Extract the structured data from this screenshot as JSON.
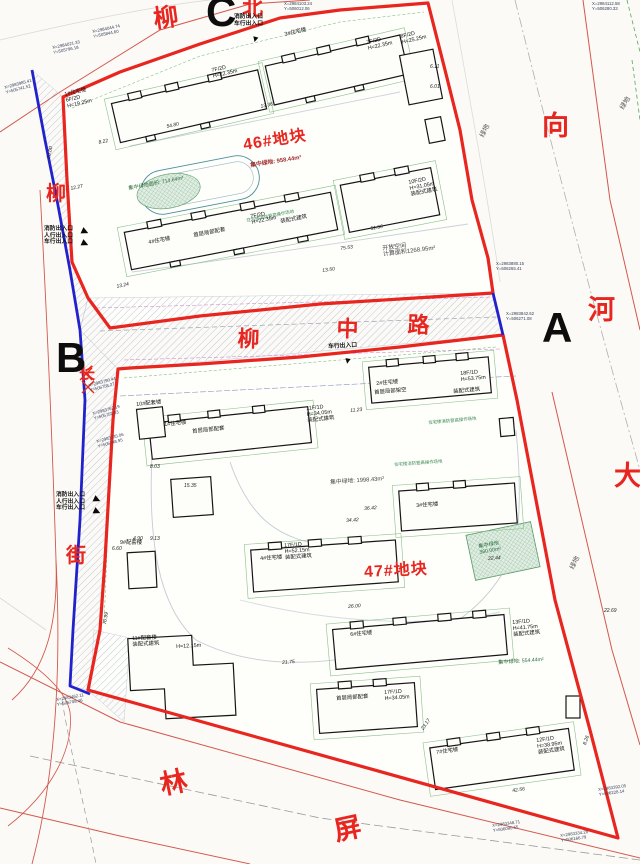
{
  "corners": {
    "a": "A",
    "b": "B",
    "c": "C"
  },
  "north": "北",
  "streets": {
    "top": "柳",
    "left": [
      "柳",
      "长",
      "街"
    ],
    "middle": [
      "柳",
      "中",
      "路"
    ],
    "right": [
      "向",
      "河",
      "大"
    ],
    "bottom": [
      "林",
      "屏"
    ]
  },
  "blocks": {
    "b46": "46#地块",
    "b47": "47#地块"
  },
  "areas": {
    "central_green_46": "集中绿地: 958.44m²",
    "oval_green": "集中绿地面积: 714.64m²",
    "open_space": [
      "开放空间",
      "计算面积1268.95m²"
    ],
    "central_green_47": "集中绿地: 1998.43m²",
    "green_rect": [
      "集中绿地",
      "360.00m²"
    ],
    "green_47b": "集中绿地: 554.44m²",
    "roadside_green": "绿地",
    "fire_lane": "住宅楼消防登高操作场地"
  },
  "entrances": {
    "top": [
      "消防出入口",
      "车行出入口"
    ],
    "left_upper": [
      "消防出入口",
      "人行出入口",
      "车行出入口"
    ],
    "left_lower": [
      "消防出入口",
      "人行出入口",
      "车行出入口"
    ],
    "middle": [
      "车行出入口"
    ]
  },
  "icons": {
    "arrow_down": "▼",
    "arrow_right": "▶"
  },
  "buildings": [
    {
      "lines": [
        "1#住宅楼",
        "6F/2D",
        "H=19.25m"
      ]
    },
    {
      "lines": [
        "7F/2D",
        "H=22.35m"
      ]
    },
    {
      "lines": [
        "3#住宅楼"
      ]
    },
    {
      "lines": [
        "7F/2D",
        "H=22.35m"
      ]
    },
    {
      "lines": [
        "8F/2D",
        "H=25.25m"
      ]
    },
    {
      "lines": [
        "4#住宅楼"
      ]
    },
    {
      "lines": [
        "首层局部配套"
      ]
    },
    {
      "lines": [
        "7F/2D",
        "H=22.35m"
      ]
    },
    {
      "lines": [
        "装配式建筑"
      ]
    },
    {
      "lines": [
        "10F/2D",
        "H=31.05m",
        "装配式建筑"
      ]
    },
    {
      "lines": [
        "1#住宅楼"
      ]
    },
    {
      "lines": [
        "首层局部配套"
      ]
    },
    {
      "lines": [
        "11F/1D",
        "H=34.05m",
        "装配式建筑"
      ]
    },
    {
      "lines": [
        "10#配套楼"
      ]
    },
    {
      "lines": [
        "2#住宅楼"
      ]
    },
    {
      "lines": [
        "首层局部架空"
      ]
    },
    {
      "lines": [
        "18F/1D",
        "H=53.75m"
      ]
    },
    {
      "lines": [
        "装配式建筑"
      ]
    },
    {
      "lines": [
        "3#住宅楼"
      ]
    },
    {
      "lines": [
        "4#住宅楼"
      ]
    },
    {
      "lines": [
        "17F/1D",
        "H=52.15m",
        "装配式建筑"
      ]
    },
    {
      "lines": [
        "9#配套楼"
      ]
    },
    {
      "lines": [
        "11#配套楼",
        "装配式建筑"
      ]
    },
    {
      "lines": [
        "H=12.15m"
      ]
    },
    {
      "lines": [
        "6#住宅楼"
      ]
    },
    {
      "lines": [
        "13F/1D",
        "H=41.75m",
        "装配式建筑"
      ]
    },
    {
      "lines": [
        "首层局部配套"
      ]
    },
    {
      "lines": [
        "17F/1D",
        "H=34.05m"
      ]
    },
    {
      "lines": [
        "7#住宅楼"
      ]
    },
    {
      "lines": [
        "12F/1D",
        "H=38.95m",
        "装配式建筑"
      ]
    }
  ],
  "dims": [
    "8.22",
    "12.27",
    "13.24",
    "20.00",
    "13.36",
    "54.80",
    "51.56",
    "75.53",
    "13.50",
    "6.11",
    "6.01",
    "11.23",
    "34.42",
    "36.42",
    "22.44",
    "23.17",
    "21.75",
    "42.56",
    "8.26",
    "22.69",
    "70.99",
    "4.90",
    "9.13",
    "6.60",
    "8.03",
    "15.35",
    "26.00"
  ],
  "coords": [
    {
      "lines": [
        "X=2984044.74",
        "Y=505844.60"
      ]
    },
    {
      "lines": [
        "X=2984021.33",
        "Y=505796.18"
      ]
    },
    {
      "lines": [
        "X=2983985.41",
        "Y=505741.52"
      ]
    },
    {
      "lines": [
        "X=2984103.24",
        "Y=506012.06"
      ]
    },
    {
      "lines": [
        "X=2984112.58",
        "Y=506280.33"
      ]
    },
    {
      "lines": [
        "X=2983880.15",
        "Y=506265.41"
      ]
    },
    {
      "lines": [
        "X=2983842.62",
        "Y=506271.08"
      ]
    },
    {
      "lines": [
        "X=2983790.44",
        "Y=505758.27"
      ]
    },
    {
      "lines": [
        "X=2983762.19",
        "Y=505752.83"
      ]
    },
    {
      "lines": [
        "X=2983735.06",
        "Y=505748.95"
      ]
    },
    {
      "lines": [
        "X=2983462.11",
        "Y=505708.46"
      ]
    },
    {
      "lines": [
        "X=2983348.71",
        "Y=506090.55"
      ]
    },
    {
      "lines": [
        "X=2983334.28",
        "Y=506166.79"
      ]
    },
    {
      "lines": [
        "X=2983392.05",
        "Y=506228.14"
      ]
    }
  ]
}
